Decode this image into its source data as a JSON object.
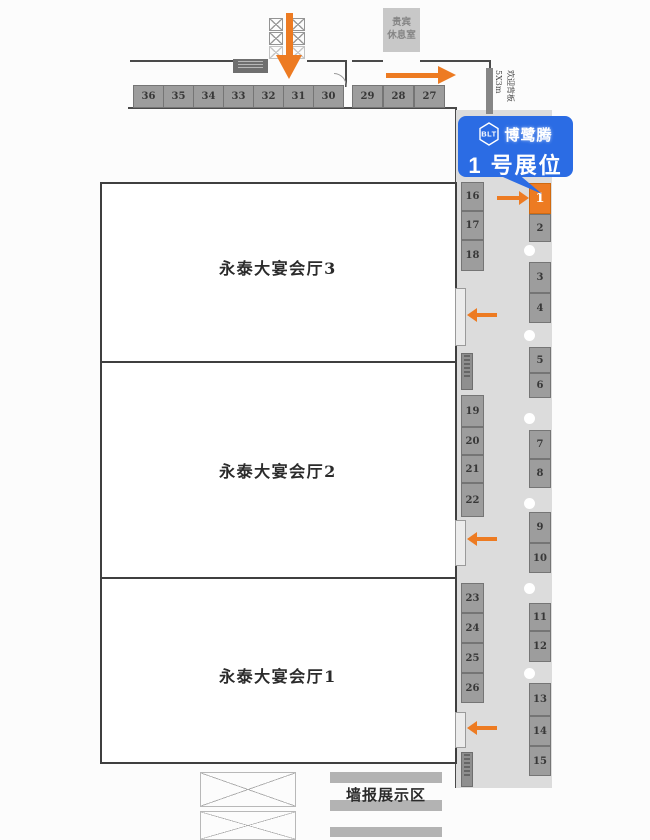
{
  "map": {
    "halls": [
      {
        "label": "永泰大宴会厅3"
      },
      {
        "label": "永泰大宴会厅2"
      },
      {
        "label": "永泰大宴会厅1"
      }
    ],
    "vip_lounge": {
      "line1": "贵宾",
      "line2": "休息室"
    },
    "welcome_board": {
      "line1": "欢迎背板",
      "line2": "5X3m"
    },
    "poster_area_label": "墙报展示区",
    "booths": {
      "top_row": [
        "36",
        "35",
        "34",
        "33",
        "32",
        "31",
        "30",
        "29",
        "28",
        "27"
      ],
      "left_column": [
        "16",
        "17",
        "18",
        "19",
        "20",
        "21",
        "22",
        "23",
        "24",
        "25",
        "26"
      ],
      "right_column": [
        "1",
        "2",
        "3",
        "4",
        "5",
        "6",
        "7",
        "8",
        "9",
        "10",
        "11",
        "12",
        "13",
        "14",
        "15"
      ],
      "highlighted_booth": "1"
    },
    "callout": {
      "logo": "BLT",
      "brand": "博鹭腾",
      "label": "1 号展位"
    },
    "colors": {
      "accent_orange": "#ed7b22",
      "brand_blue": "#2b6ce4",
      "booth_gray": "#9d9d9d",
      "corridor_gray": "#dcdcdc"
    }
  }
}
